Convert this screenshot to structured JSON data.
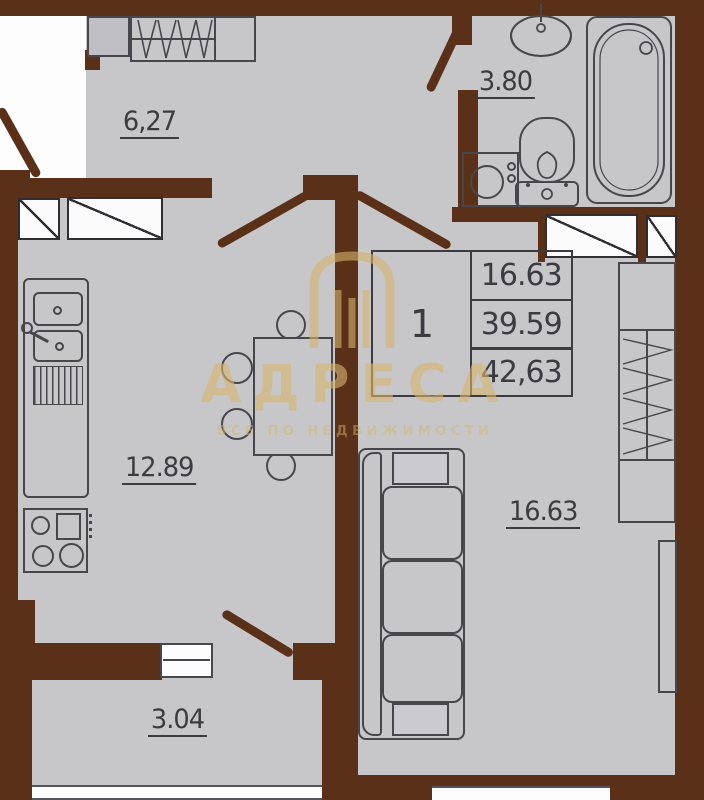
{
  "plan": {
    "rooms": [
      {
        "name": "hallway",
        "area": "6,27"
      },
      {
        "name": "bathroom",
        "area": "3.80"
      },
      {
        "name": "kitchen-living",
        "area": "12.89"
      },
      {
        "name": "room",
        "area": "16.63"
      },
      {
        "name": "balcony",
        "area": "3.04"
      }
    ],
    "info_table": {
      "rooms_count": "1",
      "rows": [
        "16.63",
        "39.59",
        "42,63"
      ]
    }
  },
  "watermark": {
    "brand": "АДРЕСА",
    "tagline": "ВСЕ ПО НЕДВИЖИМОСТИ"
  },
  "colors": {
    "wall": "#5a3118",
    "floor": "#c7c7ca",
    "outline": "#46464c",
    "watermark_gold": "#d6b36e"
  }
}
